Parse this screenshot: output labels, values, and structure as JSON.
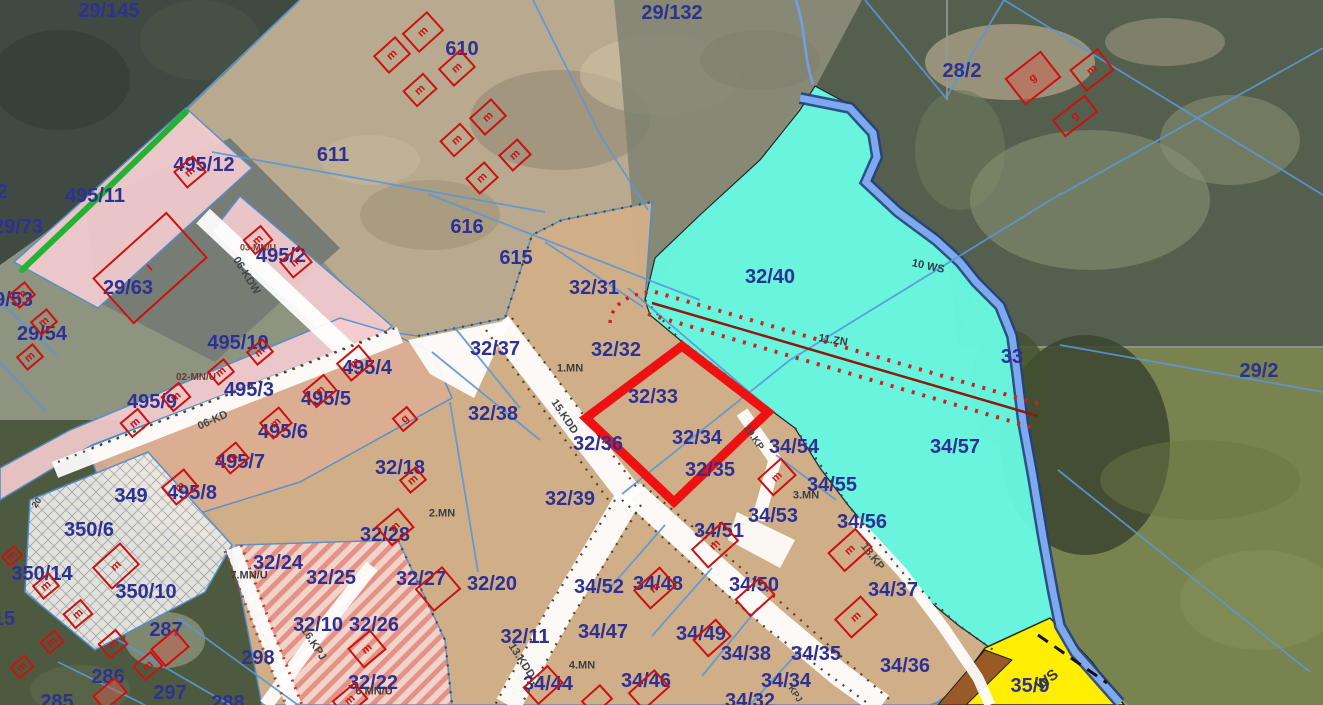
{
  "map": {
    "kind": "cadastral zoning plan over aerial imagery",
    "highlight_note": "thick red outline around parcels 32/33 and 32/34"
  },
  "colors": {
    "parcel_label": "#2e3192",
    "zone_label": "#3d3d3d",
    "zone_label_red": "#6b3a30",
    "road_label": "#41454a",
    "navy_label": "#333a4e",
    "ws_label": "#33363a",
    "cyan_zone": "#68f8e0",
    "tan_zone": "#d6b289",
    "tan_pink_zone": "#dcae93",
    "pink_zone": "#f7cdd1",
    "stripe_zone": "#f5d7cf",
    "hatch_zone": "#eceae3",
    "yellow_zone": "#ffee00",
    "brown_zone": "#9a5a28",
    "water_dark": "#24407c",
    "water_light": "#7fa9ee",
    "road_fill": "#ffffff",
    "cadastral_line": "#5a97d8",
    "boundary_green": "#21b332",
    "highlight_red": "#ee1111",
    "building_red": "#cc1111",
    "dotted_red": "#cc2222",
    "infra_center": "#8b1a10"
  },
  "labels": [
    {
      "t": "29/145",
      "x": 109,
      "y": 11,
      "k": "p"
    },
    {
      "t": "29/132",
      "x": 672,
      "y": 13,
      "k": "p"
    },
    {
      "t": "610",
      "x": 462,
      "y": 49,
      "k": "p"
    },
    {
      "t": "611",
      "x": 333,
      "y": 155,
      "k": "p"
    },
    {
      "t": "28/2",
      "x": 962,
      "y": 71,
      "k": "p"
    },
    {
      "t": "495/12",
      "x": 204,
      "y": 165,
      "k": "p"
    },
    {
      "t": "495/11",
      "x": 95,
      "y": 196,
      "k": "p"
    },
    {
      "t": "2",
      "x": 2,
      "y": 192,
      "k": "p"
    },
    {
      "t": "29/73",
      "x": 18,
      "y": 227,
      "k": "p"
    },
    {
      "t": "29/63",
      "x": 128,
      "y": 288,
      "k": "p"
    },
    {
      "t": "495/2",
      "x": 281,
      "y": 256,
      "k": "p"
    },
    {
      "t": "03-MN/U",
      "x": 258,
      "y": 248,
      "k": "zr",
      "s": 9
    },
    {
      "t": "06-KDW",
      "x": 246,
      "y": 276,
      "k": "rd",
      "r": 58
    },
    {
      "t": "29/53",
      "x": 8,
      "y": 300,
      "k": "p"
    },
    {
      "t": "29/54",
      "x": 42,
      "y": 334,
      "k": "p"
    },
    {
      "t": "495/10",
      "x": 238,
      "y": 343,
      "k": "p"
    },
    {
      "t": "02-MN/U",
      "x": 196,
      "y": 378,
      "k": "zr"
    },
    {
      "t": "495/3",
      "x": 249,
      "y": 390,
      "k": "p"
    },
    {
      "t": "495/4",
      "x": 367,
      "y": 368,
      "k": "p"
    },
    {
      "t": "495/9",
      "x": 152,
      "y": 402,
      "k": "p"
    },
    {
      "t": "495/5",
      "x": 326,
      "y": 399,
      "k": "p"
    },
    {
      "t": "06-KD",
      "x": 213,
      "y": 421,
      "k": "rd",
      "r": -24
    },
    {
      "t": "495/6",
      "x": 283,
      "y": 432,
      "k": "p"
    },
    {
      "t": "495/7",
      "x": 240,
      "y": 462,
      "k": "p"
    },
    {
      "t": "495/8",
      "x": 192,
      "y": 493,
      "k": "p"
    },
    {
      "t": "349",
      "x": 131,
      "y": 496,
      "k": "p"
    },
    {
      "t": "616",
      "x": 467,
      "y": 227,
      "k": "p"
    },
    {
      "t": "615",
      "x": 516,
      "y": 258,
      "k": "p"
    },
    {
      "t": "32/31",
      "x": 594,
      "y": 288,
      "k": "p"
    },
    {
      "t": "32/40",
      "x": 770,
      "y": 277,
      "k": "p"
    },
    {
      "t": "10 WS",
      "x": 928,
      "y": 267,
      "k": "nv",
      "r": 12,
      "s": 11
    },
    {
      "t": "32/37",
      "x": 495,
      "y": 349,
      "k": "p"
    },
    {
      "t": "32/32",
      "x": 616,
      "y": 350,
      "k": "p"
    },
    {
      "t": "1.MN",
      "x": 570,
      "y": 369,
      "k": "z"
    },
    {
      "t": "11.ZN",
      "x": 833,
      "y": 341,
      "k": "z",
      "r": 9,
      "s": 11
    },
    {
      "t": "33",
      "x": 1012,
      "y": 357,
      "k": "p"
    },
    {
      "t": "29/2",
      "x": 1259,
      "y": 371,
      "k": "p"
    },
    {
      "t": "32/38",
      "x": 493,
      "y": 414,
      "k": "p"
    },
    {
      "t": "15.KDD",
      "x": 564,
      "y": 417,
      "k": "rd",
      "r": 56
    },
    {
      "t": "32/33",
      "x": 653,
      "y": 397,
      "k": "p"
    },
    {
      "t": "32/34",
      "x": 697,
      "y": 438,
      "k": "p"
    },
    {
      "t": "32/36",
      "x": 598,
      "y": 444,
      "k": "p"
    },
    {
      "t": "34/54",
      "x": 794,
      "y": 447,
      "k": "p"
    },
    {
      "t": "34/57",
      "x": 955,
      "y": 447,
      "k": "p"
    },
    {
      "t": "19.KP",
      "x": 753,
      "y": 438,
      "k": "rd",
      "r": 56,
      "s": 10
    },
    {
      "t": "32/35",
      "x": 710,
      "y": 470,
      "k": "p"
    },
    {
      "t": "32/39",
      "x": 570,
      "y": 499,
      "k": "p"
    },
    {
      "t": "32/18",
      "x": 400,
      "y": 468,
      "k": "p"
    },
    {
      "t": "2.MN",
      "x": 442,
      "y": 514,
      "k": "z"
    },
    {
      "t": "34/55",
      "x": 832,
      "y": 485,
      "k": "p"
    },
    {
      "t": "3.MN",
      "x": 806,
      "y": 496,
      "k": "z"
    },
    {
      "t": "34/53",
      "x": 773,
      "y": 516,
      "k": "p"
    },
    {
      "t": "34/56",
      "x": 862,
      "y": 522,
      "k": "p"
    },
    {
      "t": "34/51",
      "x": 719,
      "y": 531,
      "k": "p"
    },
    {
      "t": "18.KP",
      "x": 872,
      "y": 557,
      "k": "rd",
      "r": 52
    },
    {
      "t": "34/37",
      "x": 893,
      "y": 590,
      "k": "p"
    },
    {
      "t": "34/52",
      "x": 599,
      "y": 587,
      "k": "p"
    },
    {
      "t": "34/48",
      "x": 658,
      "y": 584,
      "k": "p"
    },
    {
      "t": "34/50",
      "x": 754,
      "y": 585,
      "k": "p"
    },
    {
      "t": "32/24",
      "x": 278,
      "y": 563,
      "k": "p"
    },
    {
      "t": "7.MN/U",
      "x": 249,
      "y": 576,
      "k": "z"
    },
    {
      "t": "32/28",
      "x": 385,
      "y": 535,
      "k": "p"
    },
    {
      "t": "32/25",
      "x": 331,
      "y": 578,
      "k": "p"
    },
    {
      "t": "32/27",
      "x": 421,
      "y": 579,
      "k": "p"
    },
    {
      "t": "32/20",
      "x": 492,
      "y": 584,
      "k": "p"
    },
    {
      "t": "350/6",
      "x": 89,
      "y": 530,
      "k": "p"
    },
    {
      "t": "20",
      "x": 37,
      "y": 503,
      "k": "z",
      "r": -55,
      "s": 9
    },
    {
      "t": "350/14",
      "x": 42,
      "y": 574,
      "k": "p"
    },
    {
      "t": "350/10",
      "x": 146,
      "y": 592,
      "k": "p"
    },
    {
      "t": "287",
      "x": 166,
      "y": 630,
      "k": "p"
    },
    {
      "t": "298",
      "x": 258,
      "y": 658,
      "k": "p"
    },
    {
      "t": "32/10",
      "x": 318,
      "y": 625,
      "k": "p"
    },
    {
      "t": "32/26",
      "x": 374,
      "y": 625,
      "k": "p"
    },
    {
      "t": "16.KPJ",
      "x": 313,
      "y": 644,
      "k": "rd",
      "r": 57
    },
    {
      "t": "286",
      "x": 108,
      "y": 677,
      "k": "p"
    },
    {
      "t": "297",
      "x": 170,
      "y": 693,
      "k": "p"
    },
    {
      "t": "285",
      "x": 57,
      "y": 702,
      "k": "p"
    },
    {
      "t": "288",
      "x": 228,
      "y": 703,
      "k": "p"
    },
    {
      "t": "15",
      "x": 4,
      "y": 619,
      "k": "p"
    },
    {
      "t": "32/22",
      "x": 373,
      "y": 683,
      "k": "p"
    },
    {
      "t": "6.MN/U",
      "x": 374,
      "y": 692,
      "k": "z"
    },
    {
      "t": "32/11",
      "x": 525,
      "y": 637,
      "k": "p"
    },
    {
      "t": "13.KDD",
      "x": 521,
      "y": 661,
      "k": "rd",
      "r": 57
    },
    {
      "t": "4.MN",
      "x": 582,
      "y": 666,
      "k": "z"
    },
    {
      "t": "34/47",
      "x": 603,
      "y": 632,
      "k": "p"
    },
    {
      "t": "34/49",
      "x": 701,
      "y": 634,
      "k": "p"
    },
    {
      "t": "34/38",
      "x": 746,
      "y": 654,
      "k": "p"
    },
    {
      "t": "34/35",
      "x": 816,
      "y": 654,
      "k": "p"
    },
    {
      "t": "34/44",
      "x": 548,
      "y": 684,
      "k": "p"
    },
    {
      "t": "34/46",
      "x": 646,
      "y": 681,
      "k": "p"
    },
    {
      "t": "34/34",
      "x": 786,
      "y": 681,
      "k": "p"
    },
    {
      "t": "34/32",
      "x": 750,
      "y": 701,
      "k": "p"
    },
    {
      "t": "KPJ",
      "x": 795,
      "y": 694,
      "k": "rd",
      "r": 57,
      "s": 9
    },
    {
      "t": "35/9",
      "x": 1030,
      "y": 686,
      "k": "p"
    },
    {
      "t": "WS",
      "x": 1047,
      "y": 680,
      "k": "ws",
      "r": -38,
      "s": 15
    },
    {
      "t": "34/36",
      "x": 905,
      "y": 666,
      "k": "p"
    }
  ],
  "houses": [
    {
      "x": 423,
      "y": 32,
      "w": 34,
      "h": 26,
      "r": -42,
      "l": "m"
    },
    {
      "x": 392,
      "y": 55,
      "w": 30,
      "h": 24,
      "r": -42,
      "l": "m"
    },
    {
      "x": 457,
      "y": 68,
      "w": 30,
      "h": 24,
      "r": -42,
      "l": "m"
    },
    {
      "x": 420,
      "y": 90,
      "w": 28,
      "h": 22,
      "r": -42,
      "l": "m"
    },
    {
      "x": 488,
      "y": 117,
      "w": 30,
      "h": 24,
      "r": -42,
      "l": "m"
    },
    {
      "x": 457,
      "y": 140,
      "w": 28,
      "h": 22,
      "r": -42,
      "l": "m"
    },
    {
      "x": 515,
      "y": 155,
      "w": 26,
      "h": 22,
      "r": -42,
      "l": "m"
    },
    {
      "x": 482,
      "y": 178,
      "w": 26,
      "h": 22,
      "r": -42,
      "l": "m"
    },
    {
      "x": 1033,
      "y": 78,
      "w": 46,
      "h": 34,
      "r": -38,
      "l": "g",
      "f": 1
    },
    {
      "x": 1092,
      "y": 70,
      "w": 36,
      "h": 28,
      "r": -38,
      "l": "m"
    },
    {
      "x": 1075,
      "y": 116,
      "w": 42,
      "h": 22,
      "r": -38,
      "l": "g"
    },
    {
      "x": 190,
      "y": 172,
      "w": 26,
      "h": 22,
      "r": -40,
      "l": "m"
    },
    {
      "x": 150,
      "y": 268,
      "w": 100,
      "h": 62,
      "r": -42,
      "l": "I"
    },
    {
      "x": 22,
      "y": 295,
      "w": 22,
      "h": 18,
      "r": -40,
      "l": "m"
    },
    {
      "x": 44,
      "y": 322,
      "w": 22,
      "h": 18,
      "r": -40,
      "l": "m"
    },
    {
      "x": 30,
      "y": 357,
      "w": 22,
      "h": 18,
      "r": -40,
      "l": "m"
    },
    {
      "x": 258,
      "y": 240,
      "w": 24,
      "h": 20,
      "r": -40,
      "l": "m"
    },
    {
      "x": 296,
      "y": 262,
      "w": 26,
      "h": 22,
      "r": -40,
      "l": "m"
    },
    {
      "x": 260,
      "y": 352,
      "w": 22,
      "h": 18,
      "r": -40,
      "l": "m"
    },
    {
      "x": 221,
      "y": 372,
      "w": 22,
      "h": 18,
      "r": -40,
      "l": "m"
    },
    {
      "x": 320,
      "y": 391,
      "w": 28,
      "h": 22,
      "r": -40,
      "l": "m"
    },
    {
      "x": 355,
      "y": 363,
      "w": 30,
      "h": 24,
      "r": -40,
      "l": "m"
    },
    {
      "x": 176,
      "y": 397,
      "w": 24,
      "h": 20,
      "r": -40,
      "l": "m"
    },
    {
      "x": 135,
      "y": 423,
      "w": 24,
      "h": 20,
      "r": -40,
      "l": "m"
    },
    {
      "x": 276,
      "y": 423,
      "w": 26,
      "h": 22,
      "r": -40,
      "l": "m"
    },
    {
      "x": 233,
      "y": 458,
      "w": 26,
      "h": 22,
      "r": -40,
      "l": "m"
    },
    {
      "x": 180,
      "y": 487,
      "w": 30,
      "h": 24,
      "r": -40,
      "l": "m"
    },
    {
      "x": 405,
      "y": 419,
      "w": 20,
      "h": 18,
      "r": -40,
      "l": "g"
    },
    {
      "x": 413,
      "y": 480,
      "w": 22,
      "h": 18,
      "r": -40,
      "l": "m"
    },
    {
      "x": 395,
      "y": 527,
      "w": 30,
      "h": 26,
      "r": -40,
      "l": "m"
    },
    {
      "x": 438,
      "y": 589,
      "w": 36,
      "h": 30,
      "r": -40,
      "l": ""
    },
    {
      "x": 367,
      "y": 649,
      "w": 30,
      "h": 26,
      "r": -40,
      "l": "m"
    },
    {
      "x": 12,
      "y": 556,
      "w": 18,
      "h": 14,
      "r": -40,
      "l": "m"
    },
    {
      "x": 46,
      "y": 586,
      "w": 22,
      "h": 18,
      "r": -40,
      "l": "m"
    },
    {
      "x": 78,
      "y": 614,
      "w": 24,
      "h": 20,
      "r": -40,
      "l": "m"
    },
    {
      "x": 52,
      "y": 642,
      "w": 20,
      "h": 16,
      "r": -40,
      "l": "m"
    },
    {
      "x": 22,
      "y": 667,
      "w": 20,
      "h": 16,
      "r": -40,
      "l": "m"
    },
    {
      "x": 113,
      "y": 644,
      "w": 24,
      "h": 20,
      "r": -40,
      "l": "m"
    },
    {
      "x": 148,
      "y": 666,
      "w": 24,
      "h": 20,
      "r": -40,
      "l": "m"
    },
    {
      "x": 116,
      "y": 566,
      "w": 38,
      "h": 30,
      "r": -42,
      "l": "m"
    },
    {
      "x": 170,
      "y": 648,
      "w": 32,
      "h": 24,
      "r": -40,
      "l": "",
      "f": 1
    },
    {
      "x": 110,
      "y": 694,
      "w": 30,
      "h": 20,
      "r": -40,
      "l": "",
      "f": 1
    },
    {
      "x": 350,
      "y": 700,
      "w": 30,
      "h": 22,
      "r": -40,
      "l": "m"
    },
    {
      "x": 715,
      "y": 545,
      "w": 42,
      "h": 26,
      "r": -42,
      "l": "m"
    },
    {
      "x": 655,
      "y": 588,
      "w": 36,
      "h": 26,
      "r": -42,
      "l": "m"
    },
    {
      "x": 755,
      "y": 597,
      "w": 34,
      "h": 24,
      "r": -42,
      "l": ""
    },
    {
      "x": 850,
      "y": 550,
      "w": 38,
      "h": 26,
      "r": -42,
      "l": "m"
    },
    {
      "x": 856,
      "y": 617,
      "w": 36,
      "h": 26,
      "r": -42,
      "l": "m"
    },
    {
      "x": 712,
      "y": 638,
      "w": 32,
      "h": 24,
      "r": -42,
      "l": ""
    },
    {
      "x": 649,
      "y": 690,
      "w": 36,
      "h": 24,
      "r": -42,
      "l": ""
    },
    {
      "x": 543,
      "y": 685,
      "w": 34,
      "h": 24,
      "r": -42,
      "l": ""
    },
    {
      "x": 777,
      "y": 477,
      "w": 32,
      "h": 24,
      "r": -42,
      "l": "m"
    },
    {
      "x": 597,
      "y": 700,
      "w": 26,
      "h": 20,
      "r": -42,
      "l": ""
    }
  ]
}
